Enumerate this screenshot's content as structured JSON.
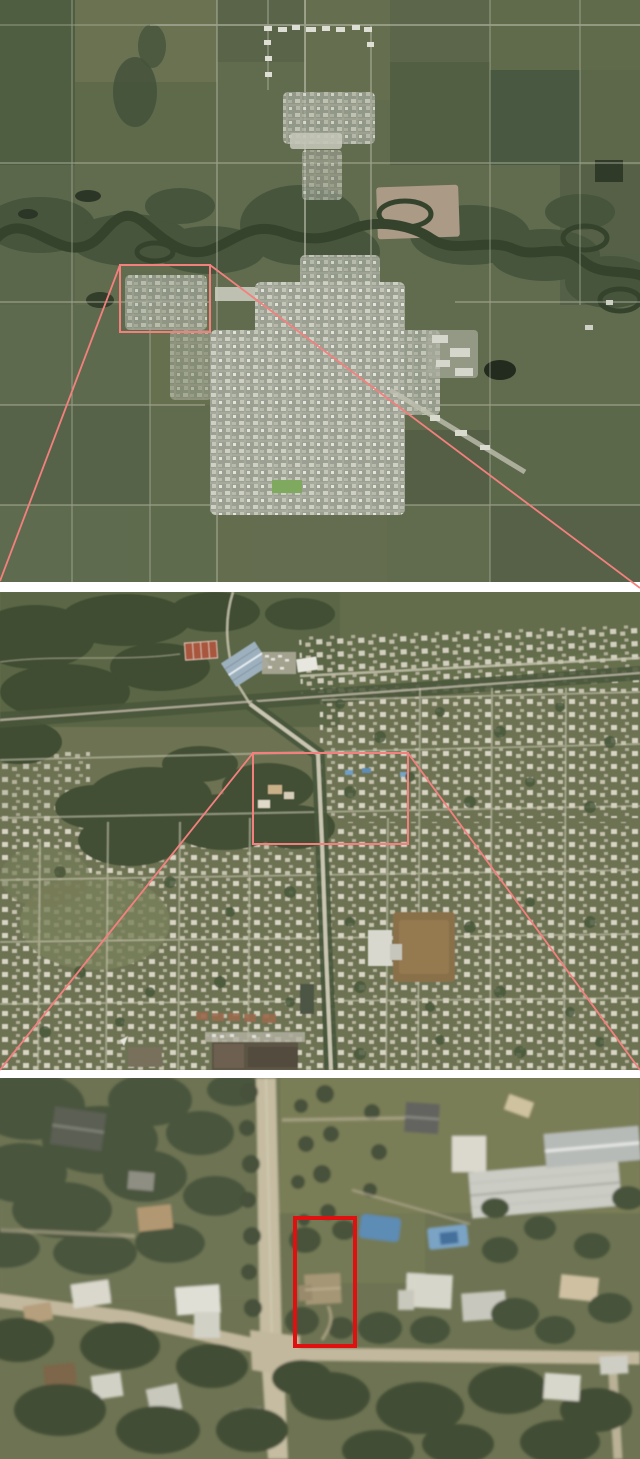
{
  "figure": {
    "kind": "aerial-zoom-sequence",
    "width": 640,
    "height": 1459,
    "background": "#ffffff",
    "alt": "Three stacked aerial photographs zooming from a town overview to a single highlighted property"
  },
  "annotation_colors": {
    "zoom_outline": "#f4807e",
    "target_outline": "#e01010"
  },
  "panels": [
    {
      "id": "overview",
      "alt": "Aerial photo of town, river valley and surrounding farmland sections",
      "x": 0,
      "y": 0,
      "width": 640,
      "height": 582,
      "highlight": {
        "x": 120,
        "y": 265,
        "width": 90,
        "height": 67,
        "color": "#f4807e",
        "stroke_width": 2
      },
      "leader_lines": [
        {
          "x1": 120,
          "y1": 265,
          "x2": 0,
          "y2": 581,
          "color": "#f4807e",
          "stroke_width": 1.8
        },
        {
          "x1": 210,
          "y1": 265,
          "x2": 640,
          "y2": 588,
          "color": "#f4807e",
          "stroke_width": 1.8
        }
      ]
    },
    {
      "id": "neighborhood",
      "alt": "Aerial photo of residential neighborhood with park, arena and rail line",
      "x": 0,
      "y": 592,
      "width": 640,
      "height": 478,
      "highlight": {
        "x": 253,
        "y": 753,
        "width": 155,
        "height": 91,
        "color": "#f4807e",
        "stroke_width": 2
      },
      "leader_lines": [
        {
          "x1": 253,
          "y1": 753,
          "x2": 0,
          "y2": 1070,
          "color": "#f4807e",
          "stroke_width": 1.8
        },
        {
          "x1": 408,
          "y1": 753,
          "x2": 640,
          "y2": 1070,
          "color": "#f4807e",
          "stroke_width": 1.8
        }
      ]
    },
    {
      "id": "property",
      "alt": "Close-up aerial photo with subject property outlined in red at street intersection",
      "x": 0,
      "y": 1078,
      "width": 640,
      "height": 381,
      "highlight": {
        "x": 295,
        "y": 1218,
        "width": 60,
        "height": 128,
        "color": "#e01010",
        "stroke_width": 4
      },
      "leader_lines": []
    }
  ]
}
